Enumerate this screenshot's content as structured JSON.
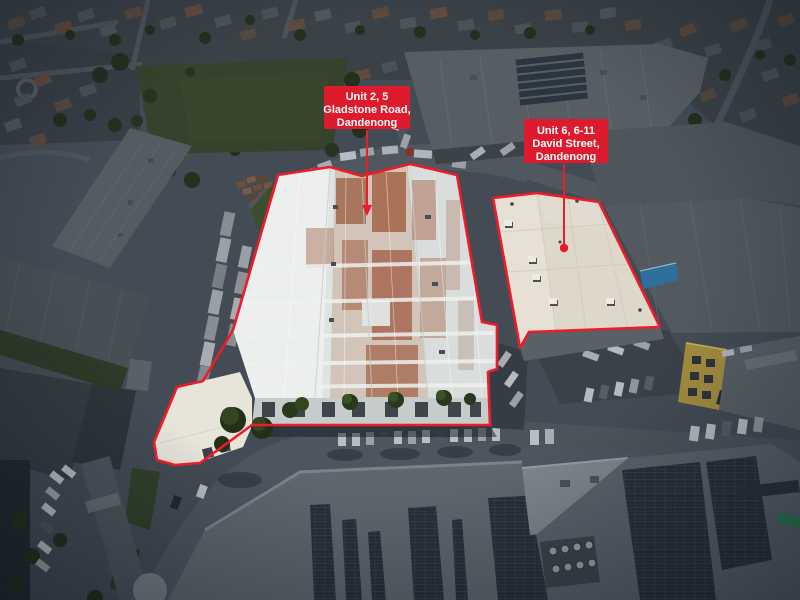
{
  "photo": {
    "kind": "aerial-property-photo",
    "highlighted_properties": 2
  },
  "labels": {
    "property_1": {
      "line1": "Unit 2, 5",
      "line2": "Gladstone Road,",
      "line3": "Dandenong"
    },
    "property_2": {
      "line1": "Unit 6, 6-11",
      "line2": "David Street,",
      "line3": "Dandenong"
    }
  },
  "colors": {
    "label_background": "#dd1b2c",
    "label_text": "#ffffff",
    "outline": "#ee1b28",
    "marker": "#e8192b"
  }
}
